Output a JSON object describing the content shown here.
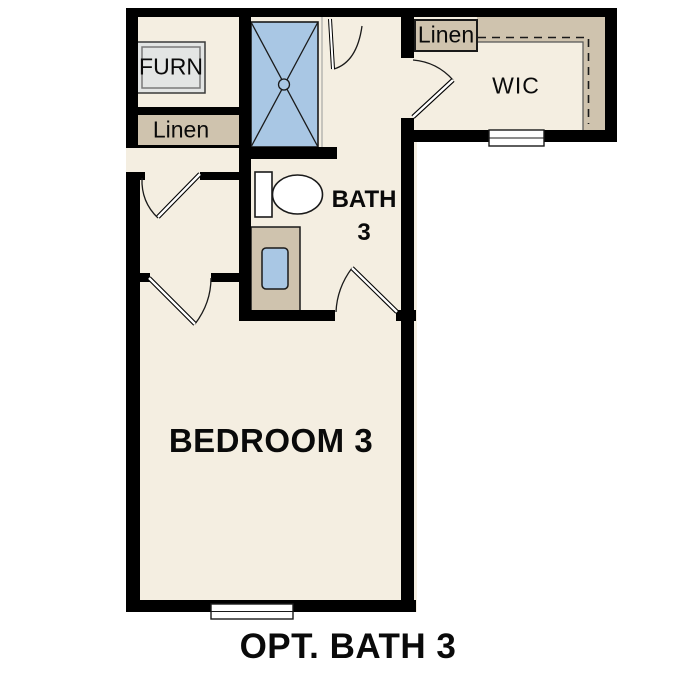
{
  "title": "OPT. BATH 3",
  "rooms": {
    "furn": {
      "label": "FURN"
    },
    "hall_linen": {
      "label": "Linen"
    },
    "bath": {
      "name_line1": "BATH",
      "name_line2": "3"
    },
    "wic": {
      "label": "WIC"
    },
    "wic_linen": {
      "label": "Linen"
    },
    "bedroom": {
      "label": "BEDROOM 3"
    }
  },
  "colors": {
    "floor": "#f4eee1",
    "casework": "#cfc3ae",
    "fixture": "#a9c7e4",
    "appliance": "#e3e5e4",
    "wall": "#000000",
    "line": "#1a1a1a",
    "bg": "#ffffff",
    "text": "#0a0a0a"
  }
}
